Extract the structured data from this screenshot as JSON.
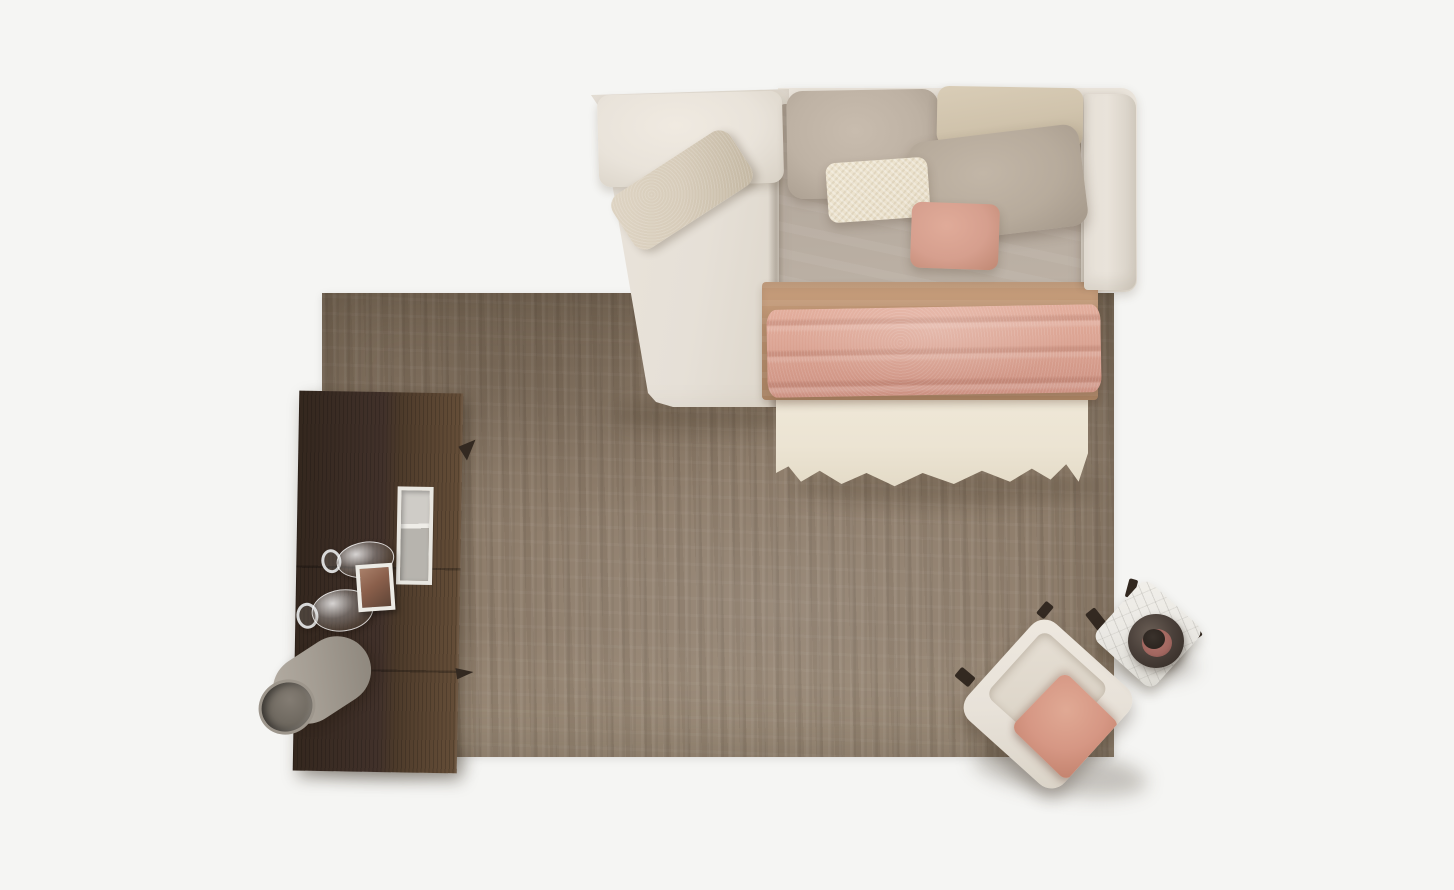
{
  "canvas": {
    "width": 1454,
    "height": 890
  },
  "scene": {
    "type": "top-down interior product photograph",
    "description": "Bird's-eye view of a cream sofa bed dressed with layered bedding and pillows on a distressed taupe rug, flanked by a dark walnut cabinet with glassware, a grey floor vase, a cream armchair with a pink cushion, and a white marble side table with a dark decorative bowl.",
    "objects": [
      {
        "id": "rug",
        "label": "distressed taupe area rug",
        "color_key": "rug_base"
      },
      {
        "id": "sofa-bed",
        "label": "cream upholstered sofa bed frame",
        "color_key": "sofa_cream"
      },
      {
        "id": "chaise-back-cushion",
        "label": "cream back cushion on chaise",
        "color_key": "cushion_cream"
      },
      {
        "id": "chaise-lumbar-pillow",
        "label": "beige woven lumbar pillow, angled on chaise",
        "color_key": "lumbar_beige"
      },
      {
        "id": "duvet",
        "label": "greige duvet on bed section",
        "color_key": "duvet_grey"
      },
      {
        "id": "pillow-greige",
        "label": "large greige pillow, top left of bed",
        "color_key": "pillow_greige"
      },
      {
        "id": "pillow-beige",
        "label": "beige pillow, top right of bed",
        "color_key": "pillow_beige"
      },
      {
        "id": "pillow-taupe",
        "label": "large taupe pillow, angled",
        "color_key": "pillow_taupe"
      },
      {
        "id": "pillow-cream",
        "label": "cream textured lumbar pillow",
        "color_key": "pillow_cream"
      },
      {
        "id": "pillow-pink",
        "label": "dusty pink square pillow",
        "color_key": "pillow_pink"
      },
      {
        "id": "blanket-tan",
        "label": "camel tan blanket band across bed",
        "color_key": "blanket_tan"
      },
      {
        "id": "throw-pink",
        "label": "dusty rose folded throw across bed",
        "color_key": "throw_pink"
      },
      {
        "id": "sheet",
        "label": "cream sheet draped over bed foot",
        "color_key": "sheet_cream"
      },
      {
        "id": "armrest",
        "label": "right armrest of sofa bed",
        "color_key": "sofa_cream_dark"
      },
      {
        "id": "cabinet",
        "label": "dark walnut storage cabinet",
        "color_key": "wood_dark"
      },
      {
        "id": "cabinet-niche",
        "label": "white framed open display niche",
        "color_key": "shelf_white"
      },
      {
        "id": "wine-glass-1",
        "label": "clear glass vessel lying on cabinet"
      },
      {
        "id": "wine-glass-2",
        "label": "clear glass vessel lying on cabinet"
      },
      {
        "id": "photo-frame",
        "label": "small white picture frame with sepia photo",
        "color_key": "photo_brown"
      },
      {
        "id": "floor-vase",
        "label": "grey cylindrical floor vase",
        "color_key": "vase_grey"
      },
      {
        "id": "armchair",
        "label": "cream armchair rotated on rug corner",
        "color_key": "chair_cream"
      },
      {
        "id": "armchair-cushion",
        "label": "salmon pink seat cushion",
        "color_key": "chair_cushion"
      },
      {
        "id": "side-table",
        "label": "white marble square side table",
        "color_key": "table_marble"
      },
      {
        "id": "decor-bowl",
        "label": "dark round bowl with rose interior",
        "color_key": "bowl_dark"
      }
    ]
  },
  "palette": {
    "background": "#f5f5f3",
    "rug_dark": "#7e6e5c",
    "rug_base": "#8f7e6c",
    "rug_light": "#9f8f7c",
    "sofa_cream": "#e6e0d7",
    "sofa_cream_dark": "#d5cec3",
    "cushion_cream": "#e9e3da",
    "lumbar_beige": "#d7ccba",
    "duvet_grey": "#b5aa9e",
    "pillow_greige": "#beb2a4",
    "pillow_beige": "#d0c3ac",
    "pillow_taupe": "#b7ab9c",
    "pillow_cream": "#e9dfca",
    "pillow_pink": "#d69f8e",
    "blanket_tan": "#bd9473",
    "throw_pink": "#d89f8e",
    "sheet_cream": "#ece4d3",
    "wood_dark": "#41312a",
    "wood_mid": "#54402e",
    "wood_light": "#654e38",
    "shelf_white": "#e9e7e1",
    "shelf_inner": "#b7b4ae",
    "photo_brown": "#8a5f4b",
    "vase_grey": "#a49d93",
    "vase_dark": "#6f6960",
    "chair_cream": "#e8e2d9",
    "chair_cushion": "#d69784",
    "table_marble": "#eae8e3",
    "bowl_dark": "#4a403a",
    "bowl_pink": "#a26760",
    "leg_dark": "#332921"
  }
}
